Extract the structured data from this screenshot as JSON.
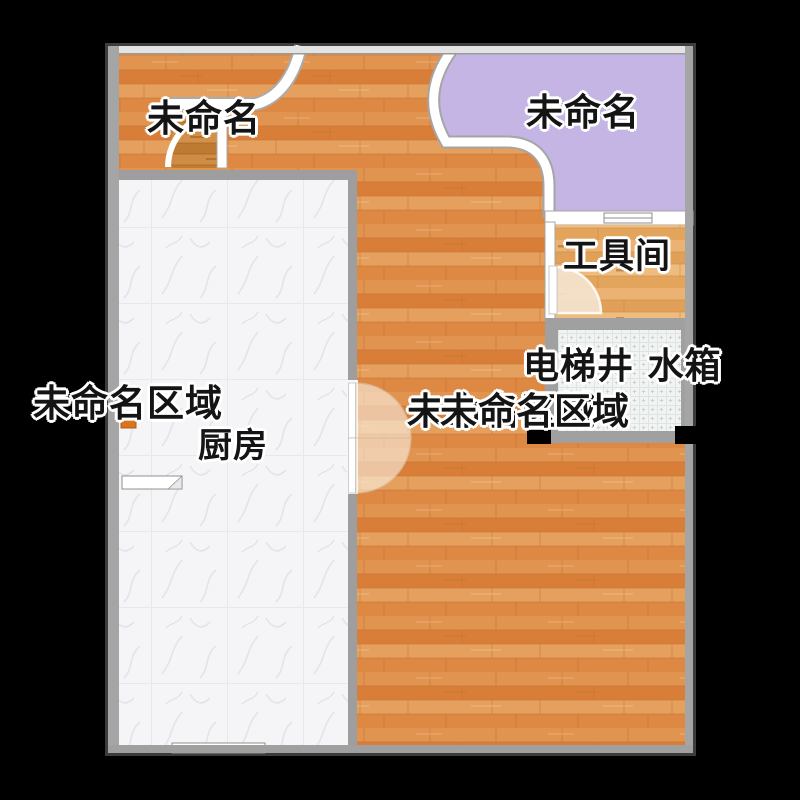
{
  "view": {
    "type": "floor-plan",
    "background": "#000000"
  },
  "palette": {
    "wood_floor": "#DF8C44",
    "light_wood_floor": "#E5A862",
    "dark_wood_floor": "#C9863C",
    "marble_floor": "#F5F5F7",
    "tile_floor": "#F2F4F4",
    "room_purple": "#C4B5E5",
    "wall_gray": "#9E9E9E",
    "wall_white": "#FFFFFF",
    "pillar_black": "#000000",
    "marker_orange": "#D9731E",
    "label_color": "#141414",
    "label_outline": "#FFFFFF"
  },
  "rooms": {
    "top_left_area": {
      "label": "未命名"
    },
    "lounge": {
      "label": "未命名"
    },
    "tool_room": {
      "label": "工具间"
    },
    "elevator_shaft": {
      "label": "电梯井 水箱"
    },
    "left_area": {
      "label": "未命名区域"
    },
    "kitchen": {
      "label": "厨房"
    },
    "center_area": {
      "label": "未命名区域"
    },
    "center_area_overlap": {
      "label": "未命名区域"
    }
  }
}
